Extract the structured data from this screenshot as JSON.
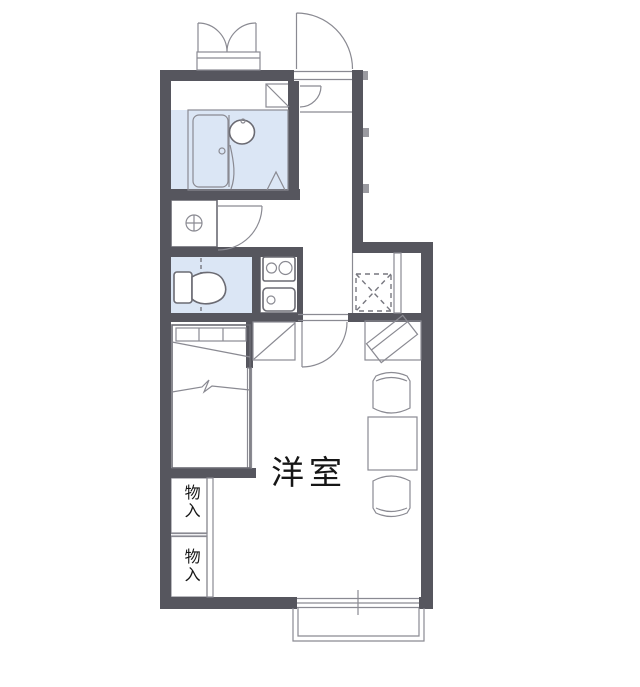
{
  "plan": {
    "type": "apartment-floor-plan",
    "labels": {
      "room": "洋室",
      "storage_upper": "物入",
      "storage_lower": "物入"
    },
    "fixtures": [
      "unit-bath-icon",
      "bathtub-icon",
      "washbasin-icon",
      "bath-folding-door-icon",
      "water-heater-cabinet-icon",
      "shoe-cabinet-door-icon",
      "entry-door-icon",
      "double-outswing-doors-icon",
      "washing-machine-pan-icon",
      "hall-door-icon",
      "toilet-icon",
      "gas-stove-2-burner-icon",
      "kitchen-sink-icon",
      "refrigerator-space-icon",
      "counter-icon",
      "tv-on-stand-icon",
      "bed-icon",
      "dining-table-icon",
      "chair-icon",
      "chair-icon",
      "storage-closet-icon",
      "sliding-window-icon",
      "balcony-icon"
    ],
    "colors": {
      "wall": "#56565e",
      "water_fixture": "#dbe6f5",
      "water_fixture_light": "#e9effa",
      "storage": "#f9ecd4",
      "cabinet": "#f7e7c9",
      "line": "#6b6b73",
      "text": "#161616",
      "background": "#ffffff"
    }
  }
}
